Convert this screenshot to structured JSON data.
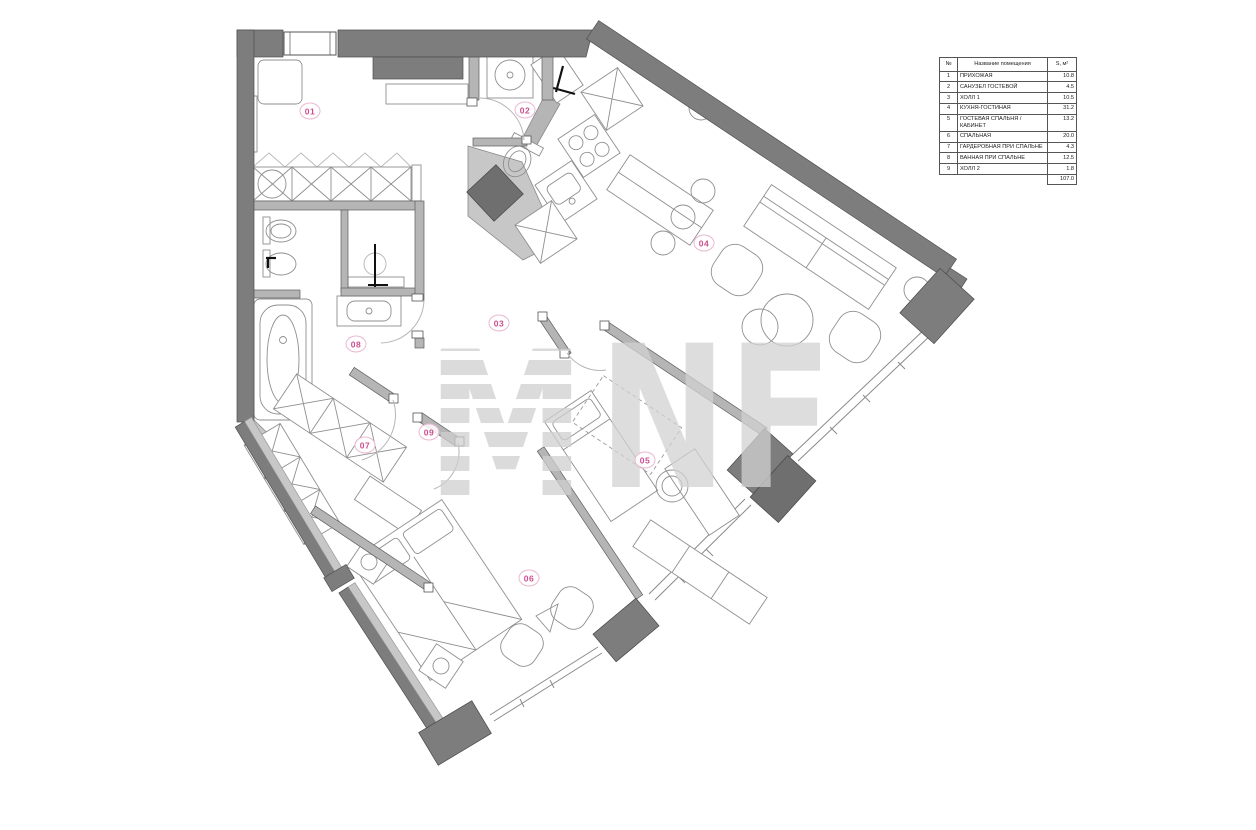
{
  "legend_table": {
    "headers": {
      "num": "№",
      "name": "Название помещения",
      "area": "S, м²"
    },
    "rows": [
      {
        "num": "1",
        "name": "ПРИХОЖАЯ",
        "area": "10.8"
      },
      {
        "num": "2",
        "name": "САНУЗЕЛ ГОСТЕВОЙ",
        "area": "4.5"
      },
      {
        "num": "3",
        "name": "ХОЛЛ 1",
        "area": "10.5"
      },
      {
        "num": "4",
        "name": "КУХНЯ-ГОСТИНАЯ",
        "area": "31.2"
      },
      {
        "num": "5",
        "name": "ГОСТЕВАЯ СПАЛЬНЯ / КАБИНЕТ",
        "area": "13.2"
      },
      {
        "num": "6",
        "name": "СПАЛЬНАЯ",
        "area": "20.0"
      },
      {
        "num": "7",
        "name": "ГАРДЕРОБНАЯ ПРИ СПАЛЬНЕ",
        "area": "4.3"
      },
      {
        "num": "8",
        "name": "ВАННАЯ ПРИ СПАЛЬНЕ",
        "area": "12.5"
      },
      {
        "num": "9",
        "name": "ХОЛЛ 2",
        "area": "1.8"
      }
    ],
    "total_area": "107.0"
  },
  "room_labels": [
    {
      "id": "01",
      "text": "01",
      "x": 310,
      "y": 111
    },
    {
      "id": "02",
      "text": "02",
      "x": 525,
      "y": 110
    },
    {
      "id": "03",
      "text": "03",
      "x": 499,
      "y": 323
    },
    {
      "id": "04",
      "text": "04",
      "x": 704,
      "y": 243
    },
    {
      "id": "05",
      "text": "05",
      "x": 645,
      "y": 460
    },
    {
      "id": "06",
      "text": "06",
      "x": 529,
      "y": 578
    },
    {
      "id": "07",
      "text": "07",
      "x": 365,
      "y": 445
    },
    {
      "id": "08",
      "text": "08",
      "x": 356,
      "y": 344
    },
    {
      "id": "09",
      "text": "09",
      "x": 429,
      "y": 432
    }
  ],
  "watermark": {
    "letter_m": "M",
    "letters_nf": "NF"
  },
  "colors": {
    "wall": "#7d7d7d",
    "wall_dark": "#6a6a6a",
    "wall_light": "#c7c7c7",
    "partition": "#b5b5b5",
    "furniture_line": "#8f8f8f",
    "door_arc": "#b5b5b5",
    "label_pink": "#cf4d8f",
    "watermark_gray": "#d2d2d2"
  }
}
